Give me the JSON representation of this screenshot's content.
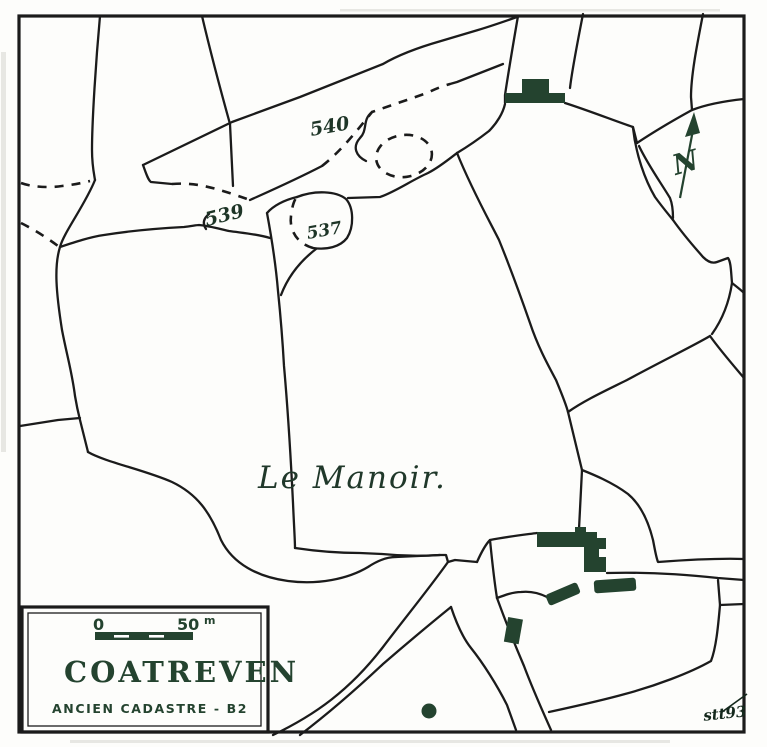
{
  "map": {
    "legend": {
      "title": "COATREVEN",
      "subtitle": "ANCIEN CADASTRE - B2",
      "scale_start": "0",
      "scale_end": "50",
      "scale_unit": "m"
    },
    "labels": {
      "place": "Le Manoir.",
      "parcel_540": "540",
      "parcel_539": "539",
      "parcel_537": "537"
    },
    "north_label": "N",
    "signature": "stt93",
    "colors": {
      "ink": "#1b1b1b",
      "feature": "#24432f",
      "paper": "#fdfdfb"
    }
  }
}
